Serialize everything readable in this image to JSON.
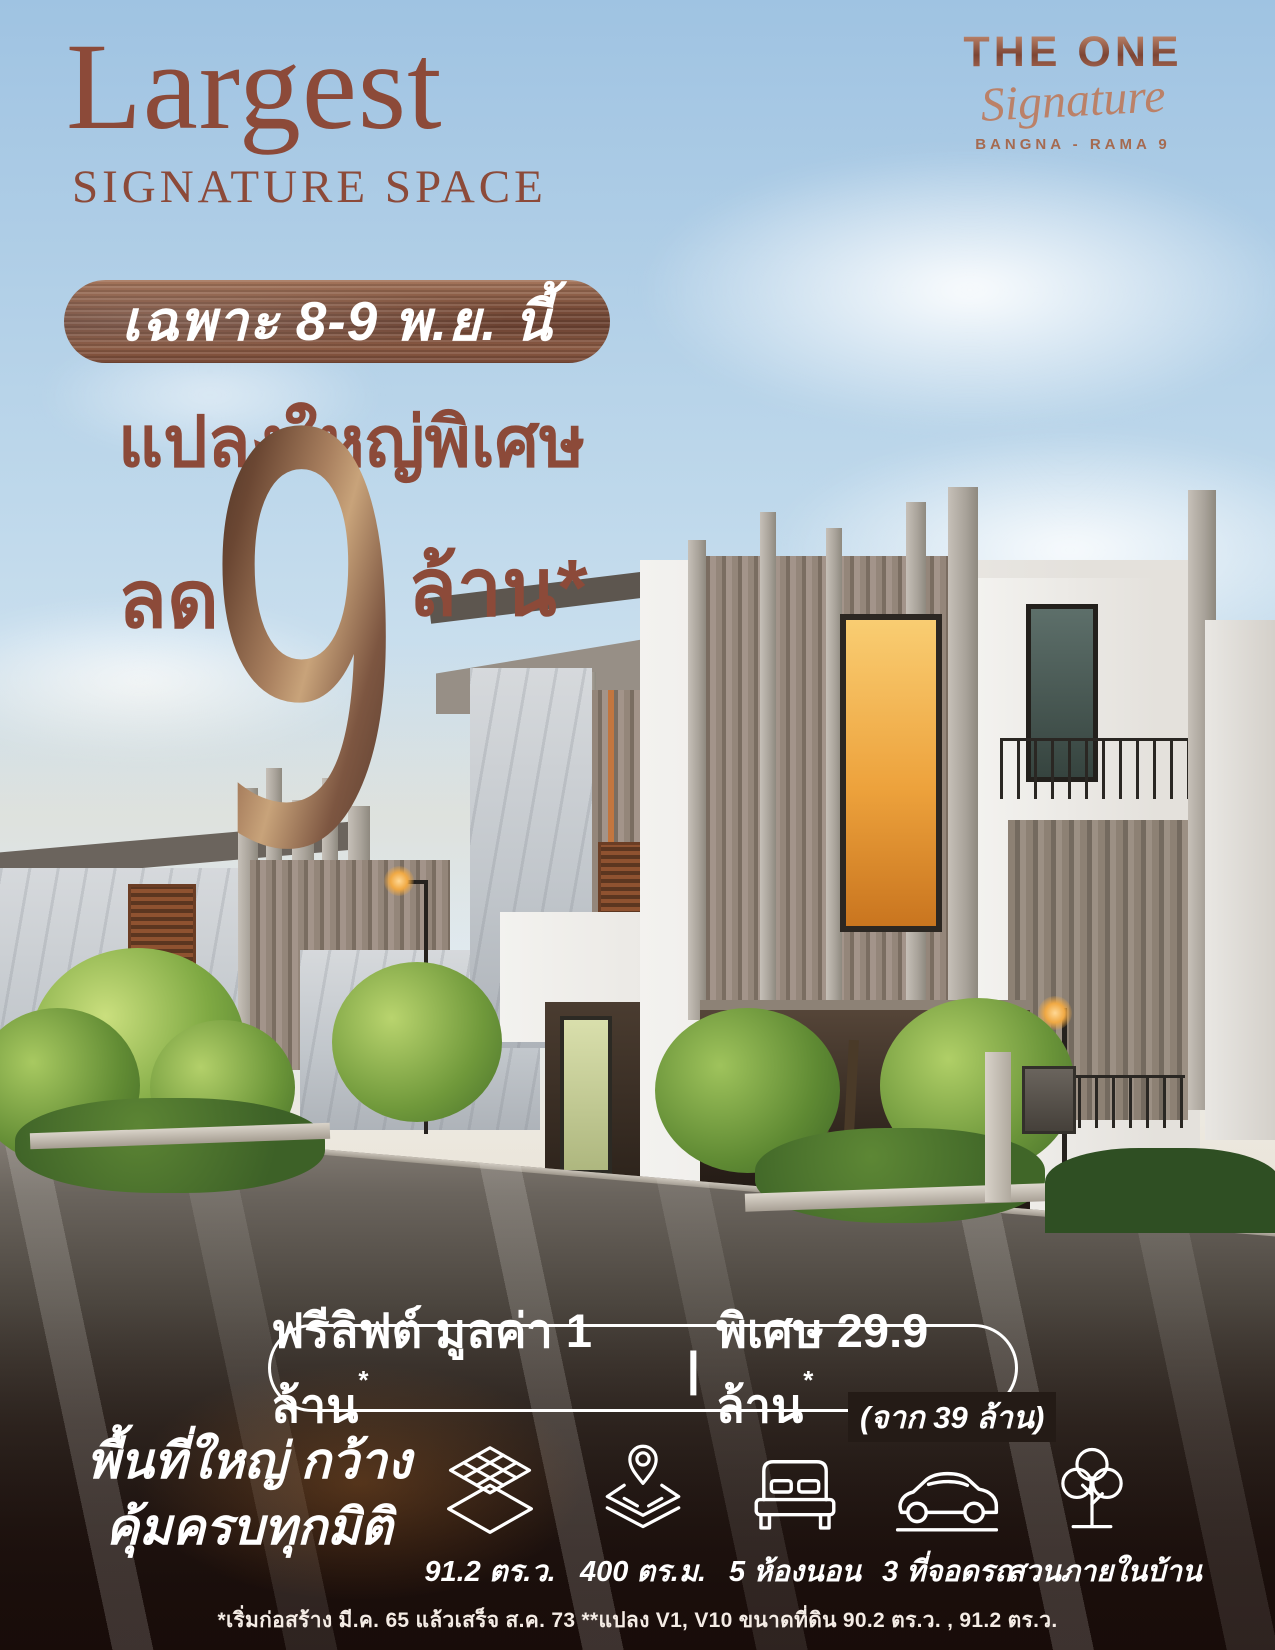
{
  "colors": {
    "brand_red": "#8c4a39",
    "copper_light": "#c8a37a",
    "copper_dark": "#6b4232",
    "sky_blue": "#aecde6",
    "text_white": "#ffffff",
    "road_dark": "#241b16",
    "window_glow": "#eda23c"
  },
  "header": {
    "title": "Largest",
    "subtitle": "SIGNATURE SPACE"
  },
  "logo": {
    "brand": "THE ONE",
    "script": "Signature",
    "location": "BANGNA - RAMA 9"
  },
  "promo": {
    "date_badge": "เฉพาะ 8-9 พ.ย. นี้",
    "headline": "แปลงใหญ่พิเศษ",
    "discount_prefix": "ลด",
    "discount_number": "9",
    "discount_suffix": "ล้าน*"
  },
  "offer": {
    "left": "ฟรีลิฟต์ มูลค่า 1 ล้าน",
    "left_sup": "*",
    "divider": "|",
    "right": "พิเศษ 29.9 ล้าน",
    "right_sup": "*",
    "from_note": "(จาก 39 ล้าน)"
  },
  "features": {
    "tagline_line1": "พื้นที่ใหญ่ กว้าง",
    "tagline_line2": "คุ้มครบทุกมิติ",
    "items": [
      {
        "icon": "floor-area-icon",
        "label": "91.2 ตร.ว."
      },
      {
        "icon": "land-area-icon",
        "label": "400 ตร.ม."
      },
      {
        "icon": "bedroom-icon",
        "label": "5 ห้องนอน"
      },
      {
        "icon": "parking-icon",
        "label": "3 ที่จอดรถ"
      },
      {
        "icon": "garden-icon",
        "label": "สวนภายในบ้าน"
      }
    ]
  },
  "footnote": "*เริ่มก่อสร้าง มี.ค. 65 แล้วเสร็จ ส.ค. 73  **แปลง V1, V10 ขนาดที่ดิน 90.2 ตร.ว. , 91.2 ตร.ว."
}
